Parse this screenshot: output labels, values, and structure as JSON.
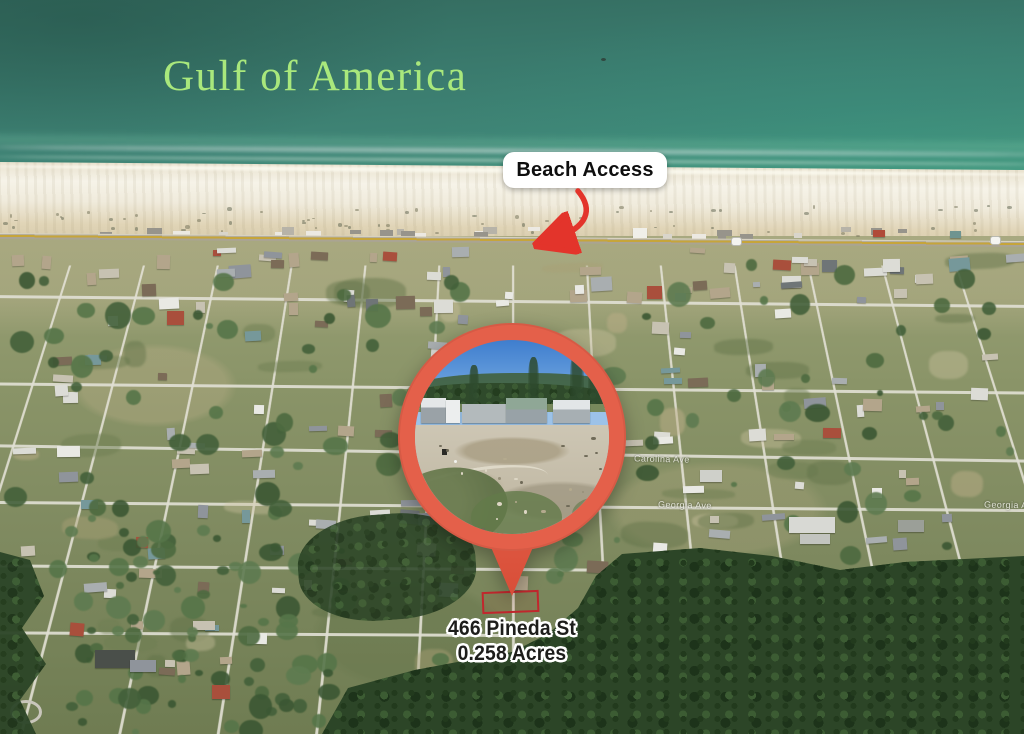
{
  "title": {
    "text": "Gulf of America"
  },
  "beach_access": {
    "label": "Beach Access"
  },
  "property": {
    "address": "466 Pineda St",
    "size": "0.258 Acres"
  },
  "street_labels": [
    {
      "text": "Carolina Ave"
    },
    {
      "text": "Georgia Ave"
    },
    {
      "text": "Georgia Ave"
    }
  ],
  "icons": {
    "beach_access_arrow": "curved-arrow-down-left",
    "location_marker": "map-pin-with-photo"
  },
  "colors": {
    "title_green": "#A9E87C",
    "pin_coral": "#E4604A",
    "arrow_red": "#E3342B",
    "boundary_red": "#C1272D",
    "water_teal": "#3A7A6D"
  }
}
